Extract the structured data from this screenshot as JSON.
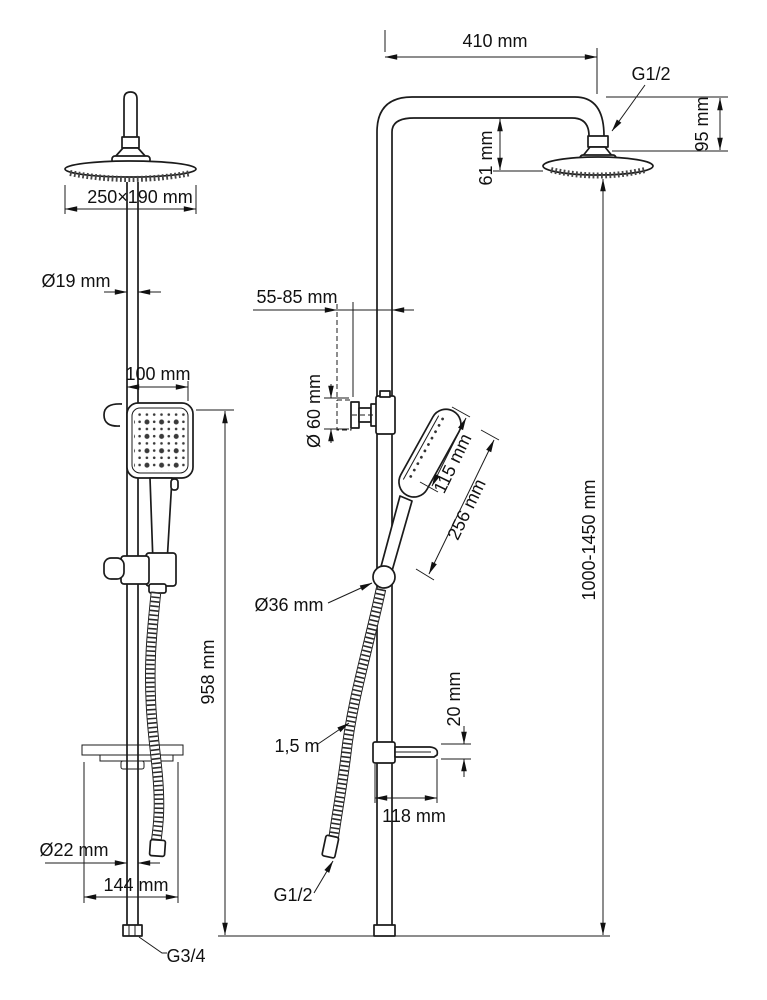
{
  "page": {
    "background": "#ffffff",
    "line_color": "#1b1b1b"
  },
  "drawing": {
    "type": "technical-dimension-drawing",
    "subject": "shower column with overhead shower, hand shower, hose and shelf — front view (left) and side view (right)"
  },
  "labels": {
    "top_width": "410 mm",
    "top_connection": "G1/2",
    "arm_to_head_height": "95 mm",
    "arm_to_face_drop": "61 mm",
    "overhead_size": "250×190 mm",
    "pipe_diameter": "Ø19 mm",
    "wall_clearance": "55-85 mm",
    "hand_shower_width": "100 mm",
    "escutcheon_diameter": "Ø 60 mm",
    "hand_shower_head_length": "115 mm",
    "hand_shower_length": "256 mm",
    "slider_diameter": "Ø36 mm",
    "rail_height": "958 mm",
    "overall_height": "1000-1450 mm",
    "shelf_thickness": "20 mm",
    "hose_length": "1,5 m",
    "shelf_depth": "118 mm",
    "lower_pipe_diameter": "Ø22 mm",
    "shelf_width": "144 mm",
    "hose_connection": "G1/2",
    "inlet_connection": "G3/4"
  }
}
